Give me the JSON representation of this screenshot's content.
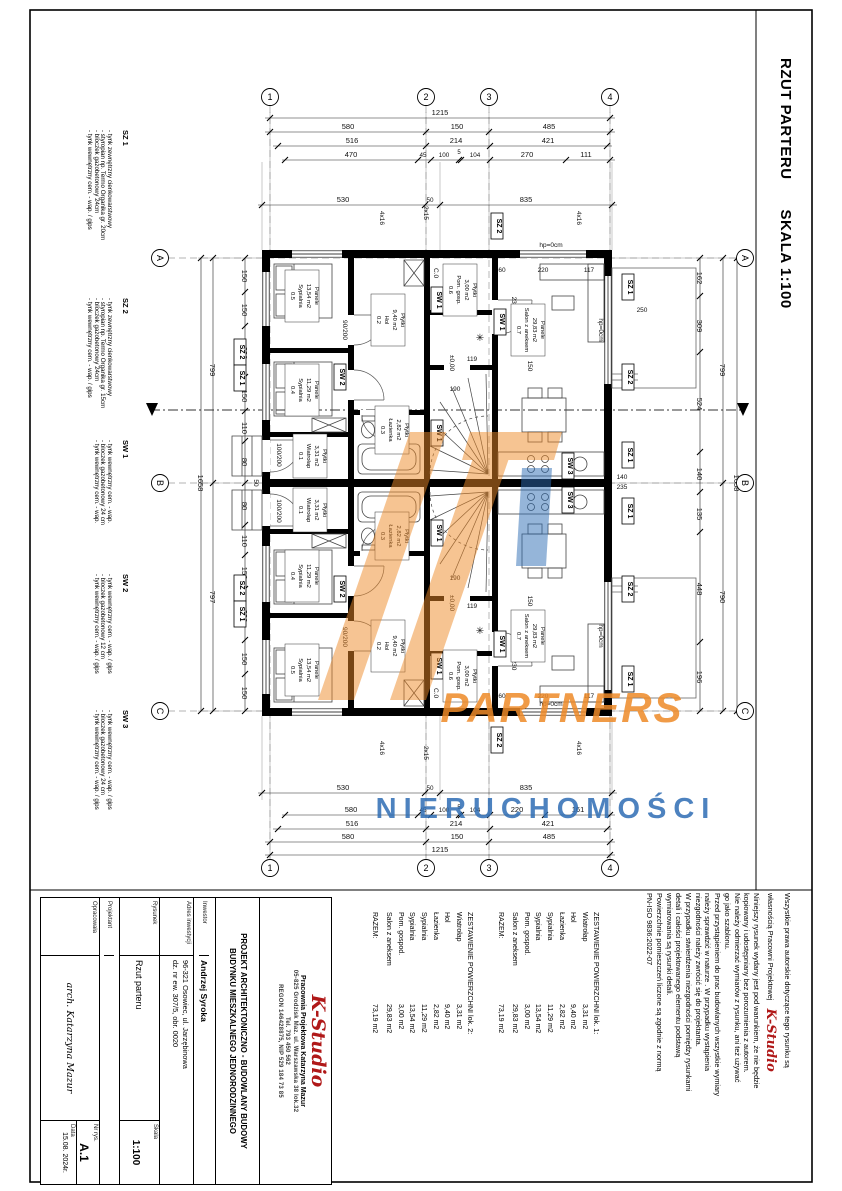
{
  "sheet": {
    "title": "RZUT PARTERU",
    "scale": "SKALA 1:100"
  },
  "legend": {
    "items": [
      {
        "code": "SZ 1",
        "lines": [
          "- tynk zewnętrzny cienkowarstwowy",
          "- styropian np. Termo Organika gr. 20cm",
          "- bloczek gazobetonowy 24cm",
          "- tynk wewnętrzny cem. - wap. / gips"
        ]
      },
      {
        "code": "SZ 2",
        "lines": [
          "- tynk zewnętrzny cienkowarstwowy",
          "- styropian np. Termo Organika gr. 15cm",
          "- bloczek gazobetonowy 24cm",
          "- tynk wewnętrzny cem. - wap. / gips"
        ]
      },
      {
        "code": "SW 1",
        "lines": [
          "- tynk wewnętrzny cem. - wap.",
          "- bloczek gazobetonowy 24 cm",
          "- tynk wewnętrzny cem. - wap."
        ]
      },
      {
        "code": "SW 2",
        "lines": [
          "- tynk wewnętrzny cem. - wap. / gips",
          "- bloczek gazobetonowy 12 cm",
          "- tynk wewnętrzny cem. - wap. / gips"
        ]
      },
      {
        "code": "SW 3",
        "lines": [
          "- tynk wewnętrzny cem. - wap. / gips",
          "- bloczek gazobetonowy 24 cm",
          "- tynk wewnętrzny cem. - wap. / gips"
        ]
      }
    ]
  },
  "tables": [
    {
      "title": "ZESTAWIENIE POWIERZCHNI   lok. 1:",
      "rows": [
        [
          "Wiatrołap",
          "3,31 m2"
        ],
        [
          "Hol",
          "9,40 m2"
        ],
        [
          "Łazienka",
          "2,82 m2"
        ],
        [
          "Sypialnia",
          "11,29 m2"
        ],
        [
          "Sypialnia",
          "13,54 m2"
        ],
        [
          "Pom. gospod.",
          "3,00 m2"
        ],
        [
          "Salon z aneksem",
          "29,83 m2"
        ]
      ],
      "total_label": "RAZEM:",
      "total": "73,19 m2"
    },
    {
      "title": "ZESTAWIENIE POWIERZCHNI   lok. 2:",
      "rows": [
        [
          "Wiatrołap",
          "3,31 m2"
        ],
        [
          "Hol",
          "9,40 m2"
        ],
        [
          "Łazienka",
          "2,82 m2"
        ],
        [
          "Sypialnia",
          "11,29 m2"
        ],
        [
          "Sypialnia",
          "13,54 m2"
        ],
        [
          "Pom. gospod.",
          "3,00 m2"
        ],
        [
          "Salon z aneksem",
          "29,83 m2"
        ]
      ],
      "total_label": "RAZEM:",
      "total": "73,19 m2"
    }
  ],
  "copyright": {
    "intro1": "Wszystkie prawa autorskie dotyczące tego rysunku są",
    "intro2": "własnością Pracowni Projektowej",
    "brand": "K-Studio",
    "lines": [
      "Niniejszy rysunek wydany jest pod warunkiem, że nie będzie",
      "kopiowany i udostępniany bez porozumienia z autorem.",
      "Nie należy odmierzać wymiarów z rysunku, ani też używać",
      "go jako szablonu.",
      "Przed przystąpieniem do prac budowlanych wszystkie wymiary",
      "należy sprawdzić w naturze . W przypadku wystąpienia",
      "niezgodności należy zwrócić się do projektanta.",
      "W przypadku stwierdzenia niezgodności pomiędzy rysunkami",
      "detali i całości projektowanego elementu podstawą",
      "wymiarowania są rysunki detali.",
      "Powierzchnie pomieszczeń liczone są zgodnie z normą",
      "PN-ISO 9836:2022-07"
    ]
  },
  "titleblock": {
    "brand": "K-Studio",
    "studio_line1": "Pracownia Projektowa Katarzyna Mazur",
    "studio_line2": "05-825 Grodzisk Maz.  ul. Warszawska 38  lok.32",
    "studio_line3": "Tel. 793 450 562",
    "studio_line4": "REGON 146428875, NIP 529 184 73 85",
    "project_line1": "PROJEKT ARCHITEKTONICZNO - BUDOWLANY BUDOWY",
    "project_line2": "BUDYNKU MIESZKALNEGO JEDNORODZINNEGO",
    "inwestor_label": "Inwestor",
    "inwestor": "Andrzej Syroka",
    "adres_label": "Adres inwestycji",
    "adres1": "96-321 Osowiec, ul. Jarzębinowa",
    "adres2": "dz. nr ew. 307/5,  obr. 0020",
    "rysunek_label": "Rysunek",
    "rysunek": "Rzut parteru",
    "skala_label": "Skala",
    "skala": "1:100",
    "projektant_label": "Projektant",
    "opracowala_label": "Opracowała",
    "autor": "arch. Katarzyna Mazur",
    "nr_label": "Nr rys.",
    "nr": "A.1",
    "data_label": "Data",
    "data": "15.08. 2024r."
  },
  "watermark": {
    "word1": "PARTNERS",
    "word2": "NIERUCHOMOŚCI",
    "orange": "#ee8a28",
    "blue": "#2e6db4"
  },
  "plan": {
    "axes": {
      "cols": [
        "1",
        "2",
        "3",
        "4"
      ],
      "rows": [
        "A",
        "B",
        "C"
      ]
    },
    "dims": {
      "total": "1215",
      "chain2": [
        "580",
        "150",
        "485"
      ],
      "chain3": [
        "516",
        "214",
        "421"
      ],
      "chain4_top": [
        "470",
        "45",
        "100",
        "5",
        "104",
        "270",
        "111"
      ],
      "chain4_bottom": [
        "580",
        "45",
        "100",
        "5",
        "104",
        "220",
        "161"
      ],
      "wall": [
        "530",
        "50",
        "835"
      ],
      "side_total": "1658",
      "side_halves": [
        "799",
        "797"
      ],
      "right_halves": [
        "799",
        "790"
      ],
      "left_segs": [
        "150",
        "150",
        "230",
        "150",
        "110",
        "80"
      ],
      "right_segs": [
        "162",
        "309",
        "524",
        "140",
        "135",
        "448",
        "196"
      ],
      "interior": {
        "d295": "295",
        "d185": "185",
        "d190": "190",
        "d119": "119",
        "d397": "397",
        "d150": "150",
        "d60": "60",
        "d220": "220",
        "d117": "117",
        "d250": "250",
        "d230": "230",
        "d140": "140",
        "d235": "235",
        "d50": "50"
      }
    },
    "tags": {
      "sz1": "SZ 1",
      "sz2": "SZ 2",
      "sw1": "SW 1",
      "sw2": "SW 2",
      "sw3": "SW 3"
    },
    "rooms": {
      "r01": [
        "0.1",
        "Wiatrołap",
        "3,31 m2",
        "Płytki"
      ],
      "r02": [
        "0.2",
        "Hol",
        "9,40 m2",
        "Płytki"
      ],
      "r03": [
        "0.3",
        "Łazienka",
        "2,82 m2",
        "Płytki"
      ],
      "r04": [
        "0.4",
        "Sypialnia",
        "11,29 m2",
        "Panele"
      ],
      "r05": [
        "0.5",
        "Sypialnia",
        "13,54 m2",
        "Panele"
      ],
      "r06": [
        "0.6",
        "Pom. gosp.",
        "3,00 m2",
        "Płytki"
      ],
      "r07": [
        "0.7",
        "Salon z aneksem",
        "29,83 m2",
        "Panele"
      ]
    },
    "annos": {
      "hp": "hp=0cm",
      "level": "±0,00",
      "steps2": "2x15",
      "steps4": "4x16",
      "chimney": "C.0",
      "d80": "80/200",
      "d90": "90/200",
      "d100": "100/200"
    }
  }
}
